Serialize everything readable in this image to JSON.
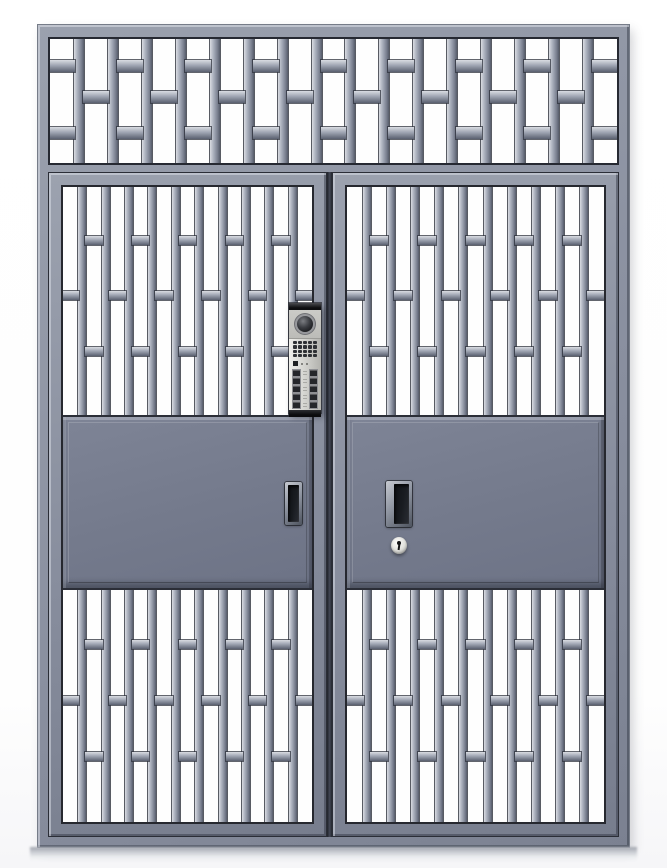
{
  "meta": {
    "description": "Blue-gray steel double security entry door: top transom grille of staggered vertical bars, two door leaves each with upper and lower staggered-bar grilles and a solid raised mid panel, a video intercom unit with camera, speaker grid and call buttons mounted near the center stile, recessed pull handles on both leaves and a round key cylinder lock on the right leaf"
  },
  "colors": {
    "background": "#ffffff",
    "steel_face": "#878d9d",
    "steel_highlight": "#dadce2",
    "steel_shadow": "#565c6a",
    "outline": "#26282f",
    "panel_face": "#747a8c",
    "opening": "#fefefe",
    "intercom_body": "#d6d6d2",
    "intercom_cap": "#0e0e10",
    "button_face": "#24262a",
    "lens": "#191a1d",
    "cylinder": "#e2e2de"
  },
  "transom_grille": {
    "bars": 16,
    "bar_width": 10,
    "rung_height": 12,
    "even_gap": "double",
    "patterns": {
      "single": [
        0.42
      ],
      "double": [
        0.17,
        0.71
      ]
    }
  },
  "door_grille": {
    "bars": 10,
    "bar_width": 8,
    "rung_height": 9,
    "even_gap": "single",
    "patterns": {
      "single": [
        0.455
      ],
      "double": [
        0.215,
        0.7
      ]
    }
  },
  "left_door": {
    "handle": "recessed vertical pull"
  },
  "right_door": {
    "handle": "recessed vertical pull",
    "lock": "round key cylinder with keyhole"
  },
  "intercom": {
    "camera": "round lens",
    "speaker": {
      "rows": 4,
      "cols": 5
    },
    "indicator": {
      "squares": 1,
      "dots": 2
    },
    "call_buttons": {
      "rows": 5,
      "cols": 2
    }
  }
}
